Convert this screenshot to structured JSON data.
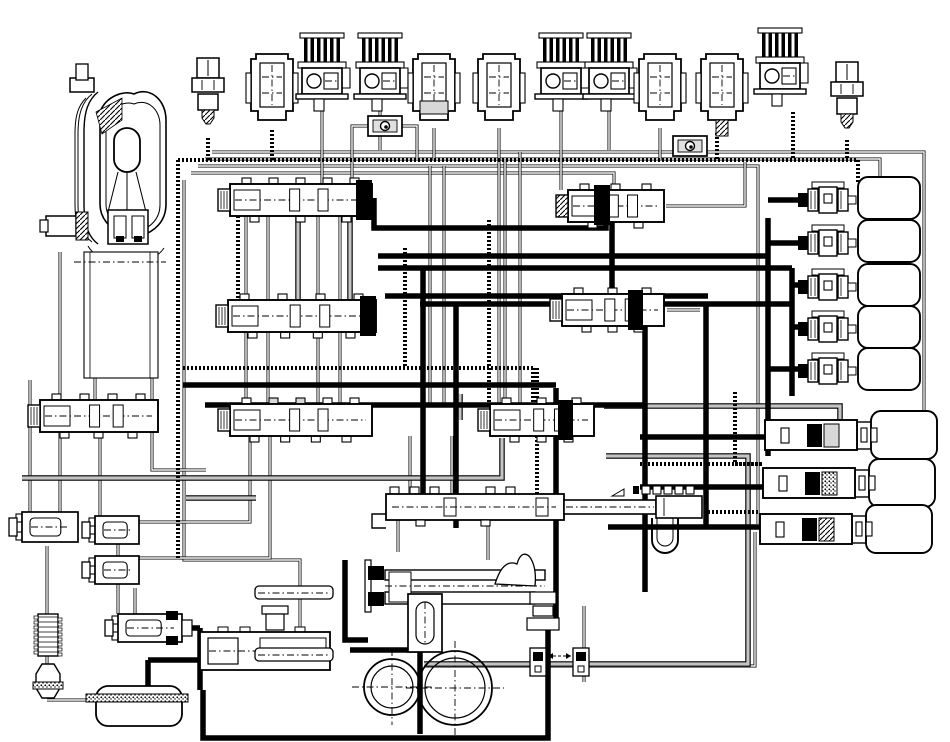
{
  "diagram": {
    "title": "automatic-transmission-hydraulic-circuit",
    "type": "hydraulic-schematic",
    "canvas": {
      "width": 950,
      "height": 742,
      "background": "#ffffff"
    },
    "colors": {
      "line": "#000000",
      "fill": "#ffffff",
      "gray_pipe": "#c4c4c4",
      "shade": "#d8d8d8",
      "check_inner": "#e0e0e0"
    },
    "line_styles": {
      "thin": "hollow double hairline hydraulic passage",
      "thick": "solid heavy main pressure line",
      "dot": "stippled / dotted signal line",
      "gray": "gray filled passage with dark edges"
    },
    "components": [
      {
        "id": "torque-converter",
        "type": "torqueConverter",
        "x": 45,
        "y": 64
      },
      {
        "id": "case-block",
        "type": "caseBlock",
        "x": 84,
        "y": 252,
        "w": 74,
        "h": 126
      },
      {
        "id": "pressure-switch-1",
        "type": "pressureSwitch",
        "cx": 208,
        "y": 58
      },
      {
        "id": "solenoid-1",
        "type": "solenoidPlain",
        "cx": 272,
        "y": 45
      },
      {
        "id": "solenoid-2",
        "type": "solenoidFinned",
        "cx": 322,
        "y": 33
      },
      {
        "id": "solenoid-3",
        "type": "solenoidFinned",
        "cx": 380,
        "y": 33
      },
      {
        "id": "solenoid-4",
        "type": "solenoidPlain",
        "cx": 434,
        "y": 45,
        "variant": "shade"
      },
      {
        "id": "solenoid-5",
        "type": "solenoidPlain",
        "cx": 499,
        "y": 45
      },
      {
        "id": "solenoid-6",
        "type": "solenoidFinned",
        "cx": 561,
        "y": 33
      },
      {
        "id": "solenoid-7",
        "type": "solenoidFinned",
        "cx": 609,
        "y": 33
      },
      {
        "id": "solenoid-8",
        "type": "solenoidPlain",
        "cx": 660,
        "y": 45
      },
      {
        "id": "solenoid-9",
        "type": "solenoidPlain",
        "cx": 722,
        "y": 45,
        "variant": "hatch"
      },
      {
        "id": "solenoid-10",
        "type": "solenoidFinned",
        "cx": 780,
        "y": 28
      },
      {
        "id": "pressure-switch-2",
        "type": "pressureSwitch",
        "cx": 847,
        "y": 62
      },
      {
        "id": "check-valve-1",
        "type": "checkBox",
        "x": 368,
        "y": 116,
        "w": 34,
        "h": 20
      },
      {
        "id": "check-valve-2",
        "type": "checkBox",
        "x": 673,
        "y": 136,
        "w": 34,
        "h": 20
      },
      {
        "id": "valve-upper-left",
        "type": "spoolValve",
        "x": 230,
        "y": 184,
        "w": 142,
        "h": 32,
        "blackEnd": "right",
        "tabsTop": 5,
        "tabsBottom": 3
      },
      {
        "id": "valve-second-left",
        "type": "spoolValve",
        "x": 228,
        "y": 300,
        "w": 148,
        "h": 32,
        "blackEnd": "right",
        "tabsTop": 4,
        "tabsBottom": 4
      },
      {
        "id": "valve-upper-right",
        "type": "spoolValve",
        "x": 568,
        "y": 190,
        "w": 96,
        "h": 32,
        "blackEnd": "leftMid",
        "capHatch": true,
        "tabsTop": 3,
        "tabsBottom": 2
      },
      {
        "id": "valve-mid-right",
        "type": "spoolValve",
        "x": 562,
        "y": 294,
        "w": 102,
        "h": 32,
        "blackEnd": "rightMid",
        "tabsTop": 3,
        "tabsBottom": 3
      },
      {
        "id": "valve-left-regulator",
        "type": "spoolValve",
        "x": 40,
        "y": 400,
        "w": 118,
        "h": 32,
        "blackEnd": "none",
        "tabsTop": 4,
        "tabsBottom": 3
      },
      {
        "id": "valve-center-1",
        "type": "spoolValve",
        "x": 230,
        "y": 404,
        "w": 142,
        "h": 32,
        "blackEnd": "none",
        "grayTabs": true,
        "tabsTop": 5,
        "tabsBottom": 4
      },
      {
        "id": "valve-center-2",
        "type": "spoolValve",
        "x": 490,
        "y": 404,
        "w": 104,
        "h": 32,
        "blackEnd": "rightMid",
        "tabsTop": 3,
        "tabsBottom": 3
      },
      {
        "id": "valve-long-center",
        "type": "longValve",
        "x": 386,
        "y": 494
      },
      {
        "id": "manual-valve-assembly",
        "type": "manualAssembly",
        "x": 345,
        "y": 552
      },
      {
        "id": "valve-bottom-solenoid",
        "type": "smallValveH",
        "x": 118,
        "y": 614,
        "w": 64,
        "h": 28,
        "blackRight": true
      },
      {
        "id": "valve-bottom-assembly",
        "type": "bottomAssembly",
        "x": 200,
        "y": 600
      },
      {
        "id": "valve-small-left-1",
        "type": "smallValveH",
        "x": 22,
        "y": 512,
        "w": 56,
        "h": 30
      },
      {
        "id": "valve-small-left-2",
        "type": "smallValveH",
        "x": 95,
        "y": 516,
        "w": 44,
        "h": 28
      },
      {
        "id": "valve-small-left-3",
        "type": "smallValveH",
        "x": 95,
        "y": 556,
        "w": 44,
        "h": 28
      },
      {
        "id": "clutch-feed-1",
        "type": "fittingClutch",
        "x": 800,
        "y": 181
      },
      {
        "id": "clutch-feed-2",
        "type": "fittingClutch",
        "x": 800,
        "y": 224
      },
      {
        "id": "clutch-feed-3",
        "type": "fittingClutch",
        "x": 800,
        "y": 268
      },
      {
        "id": "clutch-feed-4",
        "type": "fittingClutch",
        "x": 800,
        "y": 310
      },
      {
        "id": "clutch-feed-5",
        "type": "fittingClutch",
        "x": 800,
        "y": 352
      },
      {
        "id": "accumulator-1",
        "type": "accumulator",
        "x": 765,
        "y": 420,
        "variant": "gray"
      },
      {
        "id": "accumulator-2",
        "type": "accumulator",
        "x": 763,
        "y": 468,
        "variant": "dots"
      },
      {
        "id": "accumulator-3",
        "type": "accumulator",
        "x": 760,
        "y": 514,
        "variant": "hatch"
      },
      {
        "id": "gerotor-pump",
        "type": "pump",
        "c1": [
          392,
          687,
          28,
          21
        ],
        "c2": [
          455,
          688,
          37,
          30
        ]
      },
      {
        "id": "oil-pan",
        "type": "oilPan",
        "x": 96,
        "y": 686,
        "w": 86,
        "h": 40
      },
      {
        "id": "oil-cooler",
        "type": "cooler",
        "x": 38,
        "y": 614
      },
      {
        "id": "oil-filter",
        "type": "filter",
        "x": 38,
        "y": 664
      }
    ],
    "pipes": [
      {
        "s": "thin",
        "d": "M212,152 H924 V411"
      },
      {
        "s": "thin",
        "d": "M205,159 H880 V181"
      },
      {
        "s": "thin",
        "d": "M198,166 H758 V524"
      },
      {
        "s": "thin",
        "d": "M191,173 H614 V192"
      },
      {
        "s": "thin",
        "d": "M184,180 V560 H300 V630"
      },
      {
        "s": "thin",
        "d": "M60,252 V400"
      },
      {
        "s": "thin",
        "d": "M95,378 V402"
      },
      {
        "s": "thin",
        "d": "M152,378 V470 H206"
      },
      {
        "s": "thin",
        "d": "M30,380 V512"
      },
      {
        "s": "thin",
        "d": "M47,546 V614"
      },
      {
        "s": "thin",
        "d": "M47,656 V668"
      },
      {
        "s": "thin",
        "d": "M47,700 H96"
      },
      {
        "s": "thin",
        "d": "M246,216 V300"
      },
      {
        "s": "thin",
        "d": "M268,216 V300"
      },
      {
        "s": "thin",
        "d": "M318,216 V300"
      },
      {
        "s": "thin",
        "d": "M340,216 V300"
      },
      {
        "s": "thin",
        "d": "M246,332 V404"
      },
      {
        "s": "thin",
        "d": "M268,332 V404"
      },
      {
        "s": "thin",
        "d": "M318,332 V404"
      },
      {
        "s": "thin",
        "d": "M340,332 V404"
      },
      {
        "s": "thin",
        "d": "M250,436 V522 H139"
      },
      {
        "s": "thin",
        "d": "M270,436 V558 H139"
      },
      {
        "s": "thin",
        "d": "M60,432 V512"
      },
      {
        "s": "thin",
        "d": "M100,432 V516"
      },
      {
        "s": "thin",
        "d": "M118,544 V614"
      },
      {
        "s": "thin",
        "d": "M135,588 V614"
      },
      {
        "s": "thin",
        "d": "M322,110 V184"
      },
      {
        "s": "thin",
        "d": "M380,110 V150"
      },
      {
        "s": "thin",
        "d": "M434,128 V160"
      },
      {
        "s": "thin",
        "d": "M499,128 V404"
      },
      {
        "s": "thin",
        "d": "M561,110 V190"
      },
      {
        "s": "thin",
        "d": "M609,110 V150"
      },
      {
        "s": "thin",
        "d": "M660,128 V160"
      },
      {
        "s": "thin",
        "d": "M368,126 H352 V184"
      },
      {
        "s": "thin",
        "d": "M400,126 H417 V160"
      },
      {
        "s": "thin",
        "d": "M430,166 V404"
      },
      {
        "s": "thin",
        "d": "M444,166 V404"
      },
      {
        "s": "thin",
        "d": "M505,159 V404"
      },
      {
        "s": "thin",
        "d": "M520,152 V404"
      },
      {
        "s": "thin",
        "d": "M666,206 H745 V162"
      },
      {
        "s": "thin",
        "d": "M667,310 H700"
      },
      {
        "s": "thin",
        "d": "M410,436 V494"
      },
      {
        "s": "thin",
        "d": "M452,436 V494"
      },
      {
        "s": "thin",
        "d": "M398,520 V552"
      },
      {
        "s": "thin",
        "d": "M488,520 V560"
      },
      {
        "s": "thin",
        "d": "M424,666 H755 V532"
      },
      {
        "s": "thin",
        "d": "M584,606 V682"
      },
      {
        "s": "gray",
        "d": "M22,478 H502 V438"
      },
      {
        "s": "gray",
        "d": "M186,498 H256"
      },
      {
        "s": "gray",
        "d": "M298,206 V306"
      },
      {
        "s": "gray",
        "d": "M350,212 V332"
      },
      {
        "s": "gray",
        "d": "M604,406 H840 V420"
      },
      {
        "s": "gray",
        "d": "M606,456 H748 V664 H424"
      },
      {
        "s": "gray",
        "d": "M460,394 V420"
      },
      {
        "s": "dot",
        "d": "M178,160 H858"
      },
      {
        "s": "dot",
        "d": "M178,160 V558"
      },
      {
        "s": "dot",
        "d": "M272,130 V160"
      },
      {
        "s": "dot",
        "d": "M717,133 V160"
      },
      {
        "s": "dot",
        "d": "M793,112 V160"
      },
      {
        "s": "dot",
        "d": "M847,140 V160"
      },
      {
        "s": "dot",
        "d": "M208,138 V160"
      },
      {
        "s": "dot",
        "d": "M858,160 V184"
      },
      {
        "s": "dot",
        "d": "M238,216 V306"
      },
      {
        "s": "dot",
        "d": "M489,220 V404"
      },
      {
        "s": "dot",
        "d": "M405,248 V368"
      },
      {
        "s": "dot",
        "d": "M183,368 H533"
      },
      {
        "s": "dot",
        "d": "M533,368 V404"
      },
      {
        "s": "dot",
        "d": "M537,368 V498"
      },
      {
        "s": "dot",
        "d": "M735,392 V464 H763"
      },
      {
        "s": "dot",
        "d": "M640,464 H763"
      },
      {
        "s": "dot",
        "d": "M608,512 H760"
      },
      {
        "s": "thick",
        "d": "M374,198 V228 H606 V198"
      },
      {
        "s": "thick",
        "d": "M612,222 V296"
      },
      {
        "s": "thick",
        "d": "M645,318 V437"
      },
      {
        "s": "thick",
        "d": "M378,256 H768"
      },
      {
        "s": "thick",
        "d": "M378,268 H792"
      },
      {
        "s": "thick",
        "d": "M385,296 H708"
      },
      {
        "s": "thick",
        "d": "M420,304 H792"
      },
      {
        "s": "thick",
        "d": "M768,218 V456"
      },
      {
        "s": "thick",
        "d": "M792,268 V396"
      },
      {
        "s": "thick",
        "d": "M706,304 V528"
      },
      {
        "s": "thick",
        "d": "M645,437 V592"
      },
      {
        "s": "thick",
        "d": "M423,268 V498"
      },
      {
        "s": "thick",
        "d": "M456,304 V528"
      },
      {
        "s": "thick",
        "d": "M556,388 V618"
      },
      {
        "s": "thick",
        "d": "M768,200 H800"
      },
      {
        "s": "thick",
        "d": "M768,243 H800"
      },
      {
        "s": "thick",
        "d": "M792,285 H800"
      },
      {
        "s": "thick",
        "d": "M792,327 H800"
      },
      {
        "s": "thick",
        "d": "M768,369 H800"
      },
      {
        "s": "thick",
        "d": "M640,437 H765"
      },
      {
        "s": "thick",
        "d": "M640,487 H763"
      },
      {
        "s": "thick",
        "d": "M608,527 H760"
      },
      {
        "s": "thick",
        "d": "M183,385 H556"
      },
      {
        "s": "thick",
        "d": "M205,405 H645"
      },
      {
        "s": "thick",
        "d": "M148,660 H200"
      },
      {
        "s": "thick",
        "d": "M182,628 H200"
      },
      {
        "s": "thick",
        "d": "M200,628 V690"
      },
      {
        "s": "thick",
        "d": "M148,660 V686"
      },
      {
        "s": "thick",
        "d": "M203,690 V738 H548 V620"
      },
      {
        "s": "thick",
        "d": "M345,560 V640 H368"
      },
      {
        "s": "thick",
        "d": "M350,650 H420"
      },
      {
        "s": "thick",
        "d": "M420,650 V734"
      }
    ]
  }
}
